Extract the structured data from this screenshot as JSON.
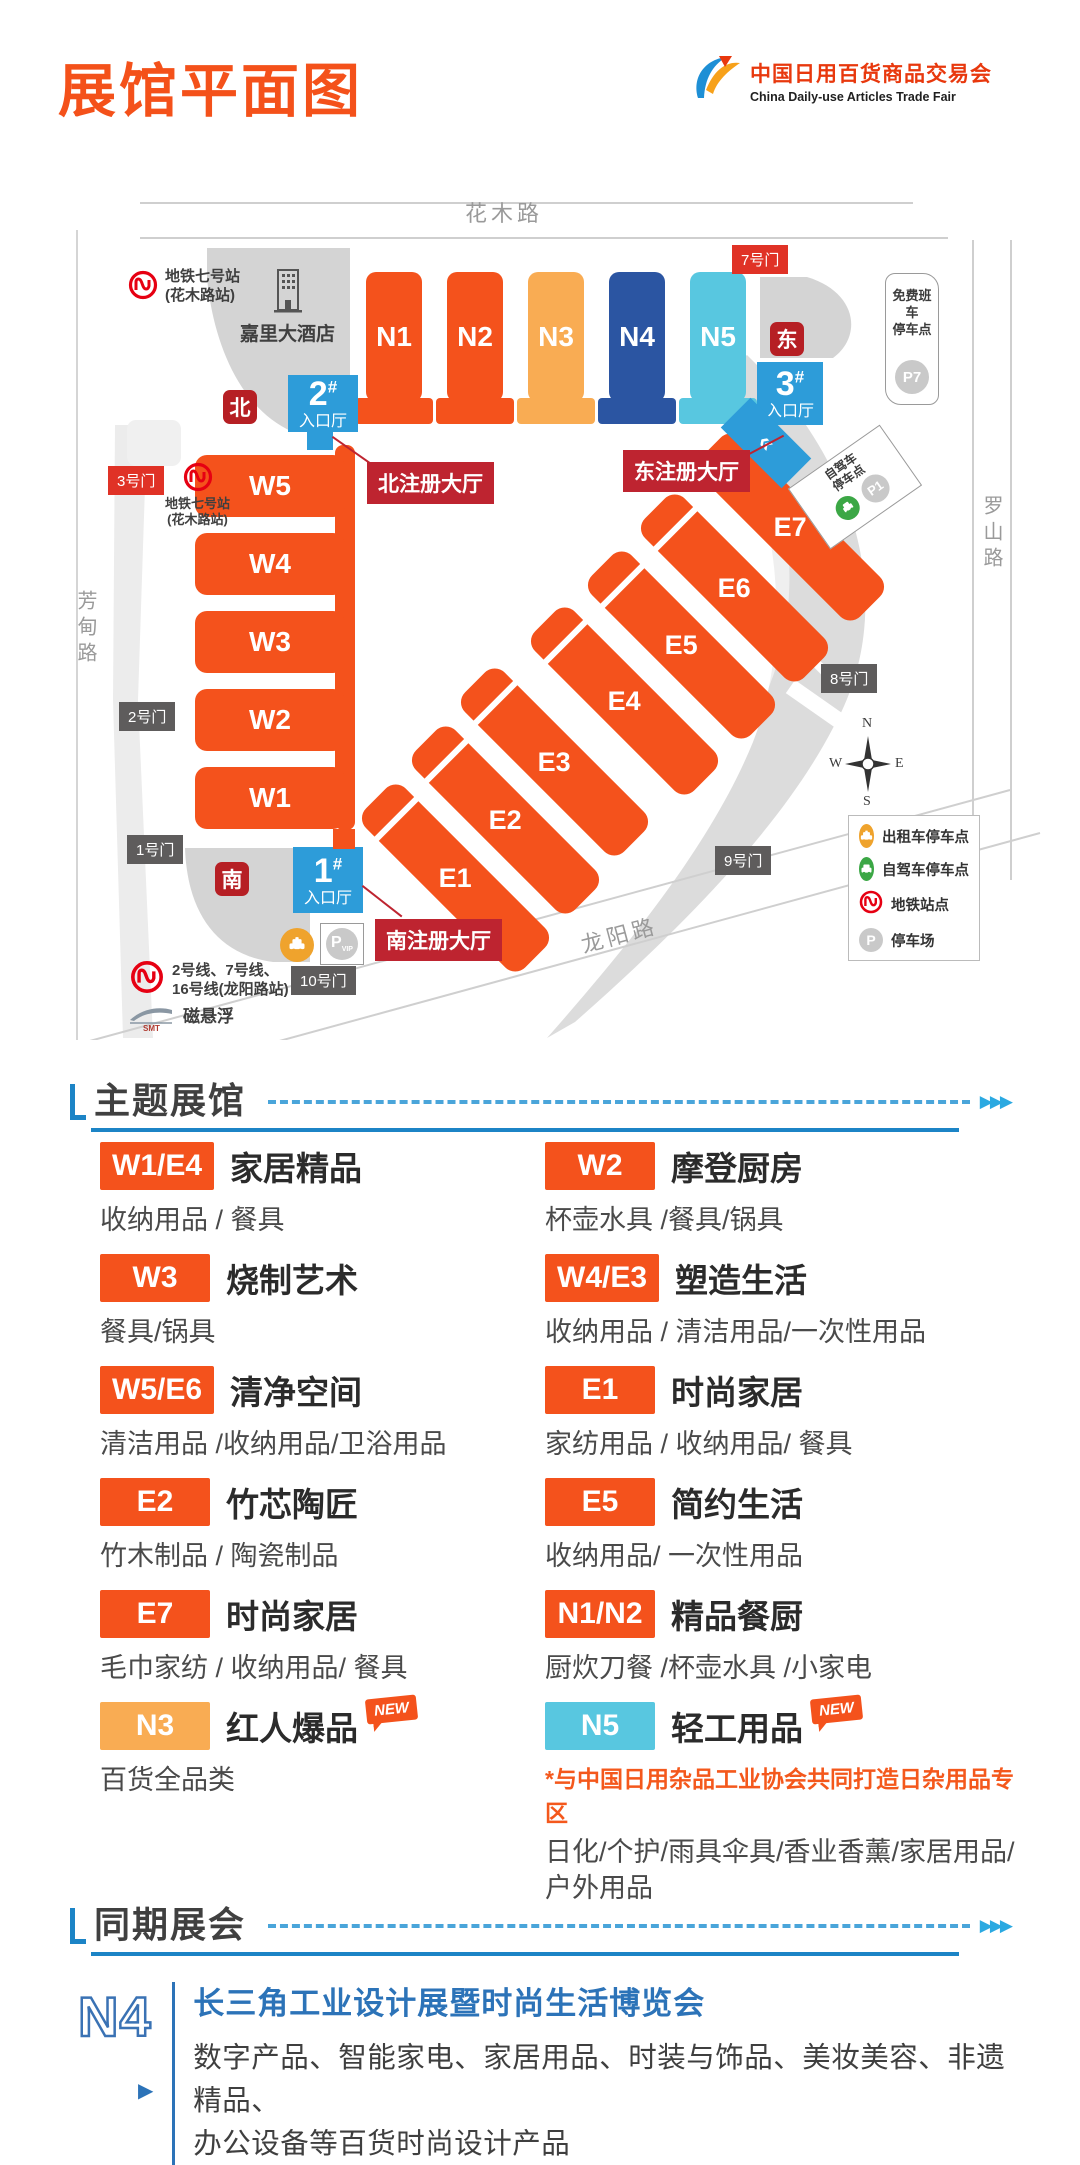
{
  "header": {
    "title": "展馆平面图",
    "logo_cn": "中国日用百货商品交易会",
    "logo_en": "China Daily-use Articles Trade Fair"
  },
  "colors": {
    "accent_orange": "#F4521C",
    "amber": "#F9AC53",
    "navy": "#2B55A2",
    "cyan": "#58C7E0",
    "entrance_blue": "#2D9CD9",
    "gate_red": "#E03226",
    "registration_red": "#BE2430",
    "section_blue": "#1C84C6",
    "n4_blue": "#2C73B8"
  },
  "map": {
    "hash": "#",
    "roads": {
      "top": "花木路",
      "left": "芳甸路",
      "right": "罗山路",
      "bottom": "龙阳路"
    },
    "halls": {
      "n1": "N1",
      "n2": "N2",
      "n3": "N3",
      "n4": "N4",
      "n5": "N5",
      "w1": "W1",
      "w2": "W2",
      "w3": "W3",
      "w4": "W4",
      "w5": "W5",
      "e1": "E1",
      "e2": "E2",
      "e3": "E3",
      "e4": "E4",
      "e5": "E5",
      "e6": "E6",
      "e7": "E7"
    },
    "entrances": {
      "n2": "2",
      "n3": "3",
      "n1": "1",
      "label": "入口厅"
    },
    "gates": {
      "g1": "1号门",
      "g2": "2号门",
      "g3": "3号门",
      "g7": "7号门",
      "g8": "8号门",
      "g9": "9号门",
      "g10": "10号门"
    },
    "directions": {
      "north": "北",
      "east": "东",
      "south": "南"
    },
    "registration": {
      "north": "北注册大厅",
      "east": "东注册大厅",
      "south": "南注册大厅"
    },
    "hotel": "嘉里大酒店",
    "metro_huamu_line1": "地铁七号站",
    "metro_huamu_line2": "(花木路站)",
    "metro_longyang_line1": "2号线、7号线、",
    "metro_longyang_line2": "16号线(龙阳路站)",
    "maglev": "磁悬浮",
    "maglev_sub": "SMT",
    "shuttle_line1": "免费班车",
    "shuttle_line2": "停车点",
    "p7": "P7",
    "selfdrive_line1": "自驾车",
    "selfdrive_line2": "停车点",
    "p1": "P1",
    "vip_p": "P",
    "vip": "VIP",
    "chevrons": "«",
    "compass": {
      "n": "N",
      "e": "E",
      "s": "S",
      "w": "W"
    },
    "legend": [
      {
        "icon": "taxi-icon",
        "label": "出租车停车点"
      },
      {
        "icon": "car-icon",
        "label": "自驾车停车点"
      },
      {
        "icon": "metro-icon",
        "label": "地铁站点"
      },
      {
        "icon": "parking-icon",
        "label": "停车场"
      }
    ]
  },
  "theme": {
    "title": "主题展馆",
    "arrows": "▶▶▶",
    "entries": [
      {
        "badge": "W1/E4",
        "title": "家居精品",
        "desc": "收纳用品 / 餐具"
      },
      {
        "badge": "W2",
        "title": "摩登厨房",
        "desc": "杯壶水具 /餐具/锅具"
      },
      {
        "badge": "W3",
        "title": "烧制艺术",
        "desc": "餐具/锅具"
      },
      {
        "badge": "W4/E3",
        "title": "塑造生活",
        "desc": "收纳用品 / 清洁用品/一次性用品"
      },
      {
        "badge": "W5/E6",
        "title": "清净空间",
        "desc": "清洁用品 /收纳用品/卫浴用品"
      },
      {
        "badge": "E1",
        "title": "时尚家居",
        "desc": "家纺用品 / 收纳用品/ 餐具"
      },
      {
        "badge": "E2",
        "title": "竹芯陶匠",
        "desc": "竹木制品 / 陶瓷制品"
      },
      {
        "badge": "E5",
        "title": "简约生活",
        "desc": "收纳用品/ 一次性用品"
      },
      {
        "badge": "E7",
        "title": "时尚家居",
        "desc": "毛巾家纺 / 收纳用品/ 餐具"
      },
      {
        "badge": "N1/N2",
        "title": "精品餐厨",
        "desc": "厨炊刀餐 /杯壶水具 /小家电"
      },
      {
        "badge": "N3",
        "title": "红人爆品",
        "new": "NEW",
        "desc": "百货全品类"
      },
      {
        "badge": "N5",
        "title": "轻工用品",
        "new": "NEW",
        "note": "*与中国日用杂品工业协会共同打造日杂用品专区",
        "desc": "日化/个护/雨具伞具/香业香薰/家居用品/户外用品"
      }
    ]
  },
  "concurrent": {
    "title": "同期展会",
    "arrows": "▶▶▶",
    "hall": "N4",
    "name": "长三角工业设计展暨时尚生活博览会",
    "desc1": "数字产品、智能家电、家居用品、时装与饰品、美妆美容、非遗精品、",
    "desc2": "办公设备等百货时尚设计产品",
    "play": "▶"
  }
}
